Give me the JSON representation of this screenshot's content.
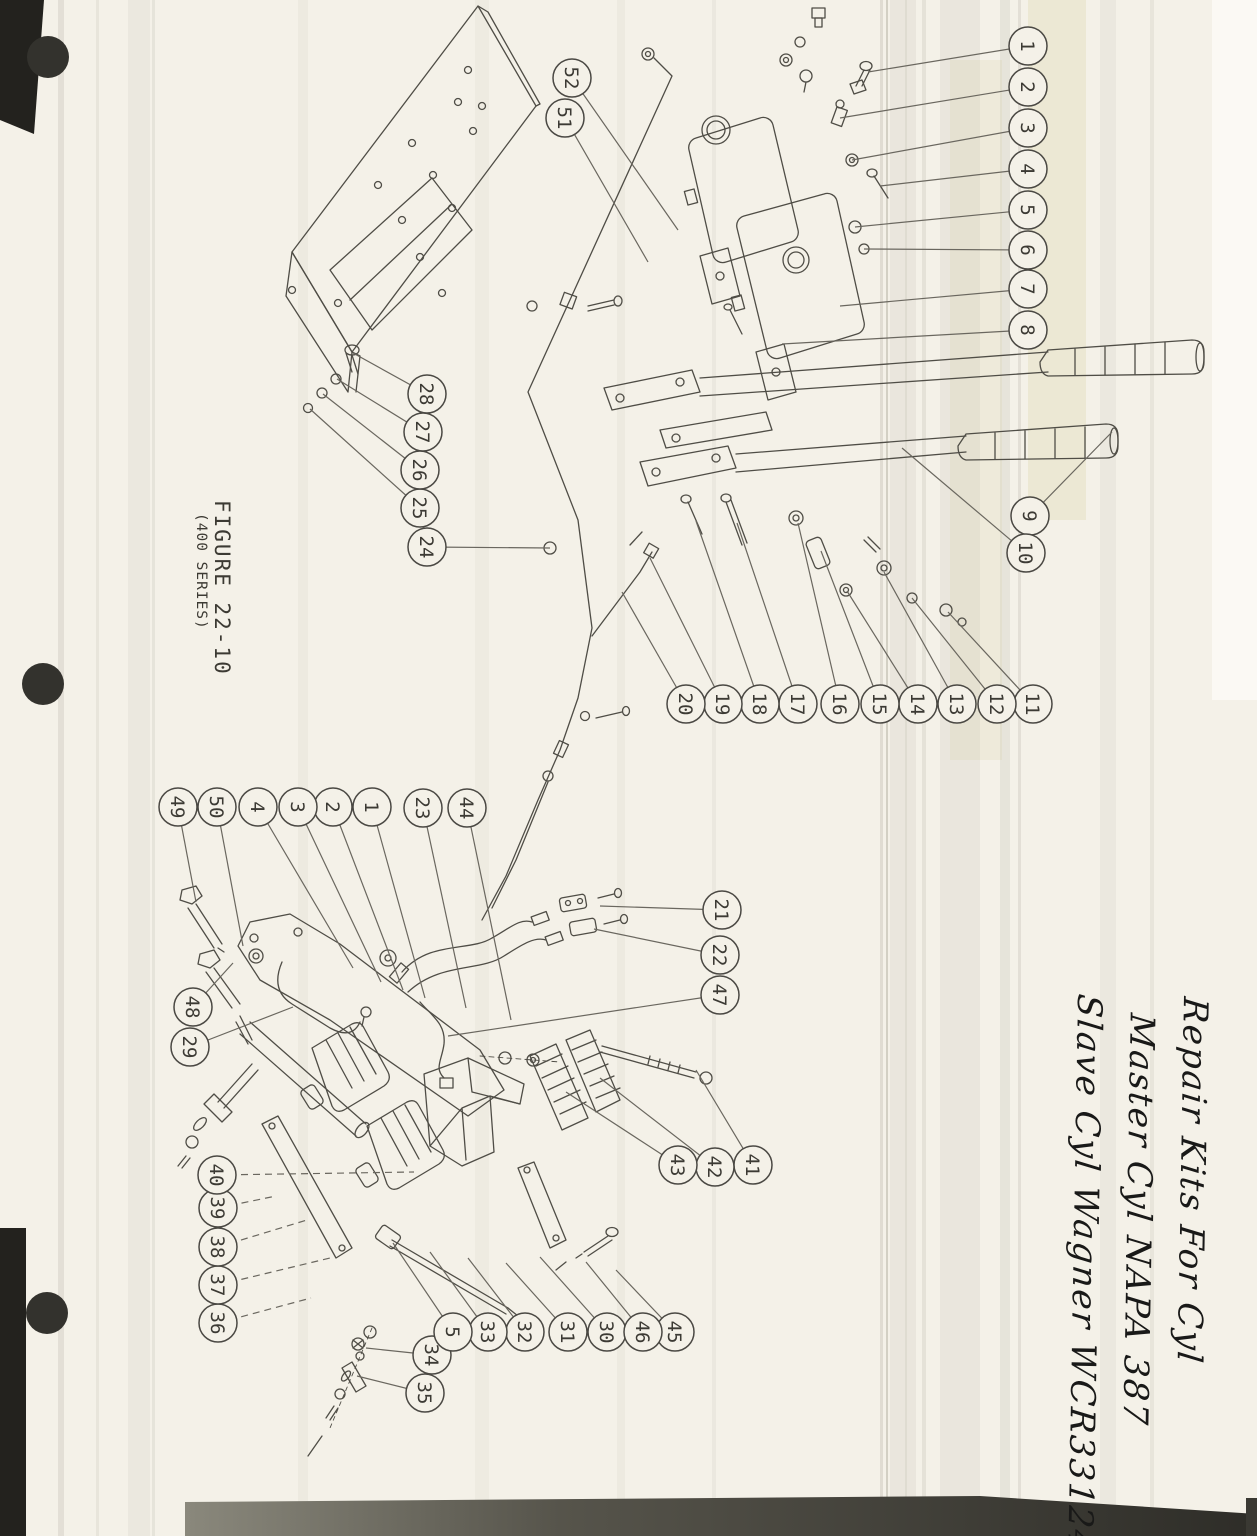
{
  "figure": {
    "title": "FIGURE 22-10",
    "subtitle": "(400 SERIES)"
  },
  "note": {
    "lines": [
      "Repair Kits For Cyl",
      "Master Cyl NAPA 387",
      "Slave Cyl Wagner WCR33124"
    ]
  },
  "colors": {
    "paper": "#f4f1e8",
    "ink": "#4f4d46",
    "leader": "#6a675f",
    "artifact_dark": "#33322d"
  },
  "callouts": [
    {
      "label": "1",
      "x": 1028,
      "y": 46,
      "tx": 868,
      "ty": 72
    },
    {
      "label": "2",
      "x": 1028,
      "y": 87,
      "tx": 840,
      "ty": 118
    },
    {
      "label": "3",
      "x": 1028,
      "y": 128,
      "tx": 852,
      "ty": 160
    },
    {
      "label": "4",
      "x": 1028,
      "y": 169,
      "tx": 880,
      "ty": 186
    },
    {
      "label": "5",
      "x": 1028,
      "y": 210,
      "tx": 855,
      "ty": 227
    },
    {
      "label": "6",
      "x": 1028,
      "y": 250,
      "tx": 864,
      "ty": 249
    },
    {
      "label": "7",
      "x": 1028,
      "y": 289,
      "tx": 840,
      "ty": 306
    },
    {
      "label": "8",
      "x": 1028,
      "y": 330,
      "tx": 782,
      "ty": 344
    },
    {
      "label": "9",
      "x": 1030,
      "y": 516,
      "tx": 1112,
      "ty": 432
    },
    {
      "label": "10",
      "x": 1026,
      "y": 553,
      "tx": 902,
      "ty": 448
    },
    {
      "label": "11",
      "x": 1033,
      "y": 704,
      "tx": 948,
      "ty": 612
    },
    {
      "label": "12",
      "x": 997,
      "y": 704,
      "tx": 912,
      "ty": 598
    },
    {
      "label": "13",
      "x": 957,
      "y": 704,
      "tx": 884,
      "ty": 572
    },
    {
      "label": "14",
      "x": 918,
      "y": 704,
      "tx": 847,
      "ty": 591
    },
    {
      "label": "15",
      "x": 880,
      "y": 704,
      "tx": 821,
      "ty": 551
    },
    {
      "label": "16",
      "x": 840,
      "y": 704,
      "tx": 798,
      "ty": 523
    },
    {
      "label": "17",
      "x": 798,
      "y": 704,
      "tx": 737,
      "ty": 523
    },
    {
      "label": "18",
      "x": 760,
      "y": 704,
      "tx": 696,
      "ty": 521
    },
    {
      "label": "19",
      "x": 723,
      "y": 704,
      "tx": 650,
      "ty": 558
    },
    {
      "label": "20",
      "x": 686,
      "y": 704,
      "tx": 622,
      "ty": 592
    },
    {
      "label": "21",
      "x": 722,
      "y": 910,
      "tx": 600,
      "ty": 906
    },
    {
      "label": "22",
      "x": 720,
      "y": 955,
      "tx": 594,
      "ty": 929
    },
    {
      "label": "23",
      "x": 423,
      "y": 808,
      "tx": 466,
      "ty": 1008
    },
    {
      "label": "24",
      "x": 427,
      "y": 547,
      "tx": 550,
      "ty": 548
    },
    {
      "label": "25",
      "x": 420,
      "y": 508,
      "tx": 310,
      "ty": 409
    },
    {
      "label": "26",
      "x": 420,
      "y": 470,
      "tx": 323,
      "ty": 394
    },
    {
      "label": "27",
      "x": 423,
      "y": 432,
      "tx": 337,
      "ty": 379
    },
    {
      "label": "28",
      "x": 427,
      "y": 394,
      "tx": 353,
      "ty": 353
    },
    {
      "label": "29",
      "x": 190,
      "y": 1047,
      "tx": 293,
      "ty": 1007
    },
    {
      "label": "30",
      "x": 607,
      "y": 1332,
      "tx": 540,
      "ty": 1257
    },
    {
      "label": "31",
      "x": 568,
      "y": 1332,
      "tx": 506,
      "ty": 1263
    },
    {
      "label": "32",
      "x": 525,
      "y": 1332,
      "tx": 468,
      "ty": 1258
    },
    {
      "label": "33",
      "x": 488,
      "y": 1332,
      "tx": 430,
      "ty": 1252
    },
    {
      "label": "34",
      "x": 432,
      "y": 1355,
      "tx": 366,
      "ty": 1348
    },
    {
      "label": "35",
      "x": 425,
      "y": 1393,
      "tx": 357,
      "ty": 1376
    },
    {
      "label": "36",
      "x": 218,
      "y": 1323,
      "tx": 311,
      "ty": 1298,
      "dash": true
    },
    {
      "label": "37",
      "x": 218,
      "y": 1285,
      "tx": 330,
      "ty": 1258,
      "dash": true
    },
    {
      "label": "38",
      "x": 218,
      "y": 1247,
      "tx": 307,
      "ty": 1220,
      "dash": true
    },
    {
      "label": "39",
      "x": 218,
      "y": 1208,
      "tx": 276,
      "ty": 1196,
      "dash": true
    },
    {
      "label": "40",
      "x": 217,
      "y": 1175,
      "tx": 414,
      "ty": 1172,
      "dash": true
    },
    {
      "label": "41",
      "x": 753,
      "y": 1165,
      "tx": 696,
      "ty": 1070
    },
    {
      "label": "42",
      "x": 715,
      "y": 1167,
      "tx": 600,
      "ty": 1078
    },
    {
      "label": "43",
      "x": 678,
      "y": 1165,
      "tx": 566,
      "ty": 1092
    },
    {
      "label": "44",
      "x": 467,
      "y": 808,
      "tx": 511,
      "ty": 1020
    },
    {
      "label": "45",
      "x": 675,
      "y": 1332,
      "tx": 616,
      "ty": 1270
    },
    {
      "label": "46",
      "x": 643,
      "y": 1332,
      "tx": 586,
      "ty": 1262
    },
    {
      "label": "47",
      "x": 720,
      "y": 995,
      "tx": 448,
      "ty": 1036
    },
    {
      "label": "48",
      "x": 193,
      "y": 1007,
      "tx": 233,
      "ty": 963
    },
    {
      "label": "49",
      "x": 178,
      "y": 807,
      "tx": 196,
      "ty": 902
    },
    {
      "label": "50",
      "x": 217,
      "y": 807,
      "tx": 243,
      "ty": 946
    },
    {
      "label": "51",
      "x": 565,
      "y": 118,
      "tx": 648,
      "ty": 262
    },
    {
      "label": "52",
      "x": 572,
      "y": 78,
      "tx": 678,
      "ty": 230
    },
    {
      "label": "1",
      "x": 372,
      "y": 807,
      "tx": 425,
      "ty": 998
    },
    {
      "label": "2",
      "x": 333,
      "y": 807,
      "tx": 403,
      "ty": 990
    },
    {
      "label": "3",
      "x": 298,
      "y": 807,
      "tx": 381,
      "ty": 982
    },
    {
      "label": "4",
      "x": 258,
      "y": 807,
      "tx": 353,
      "ty": 968
    },
    {
      "label": "5",
      "x": 453,
      "y": 1332,
      "tx": 393,
      "ty": 1243
    }
  ]
}
